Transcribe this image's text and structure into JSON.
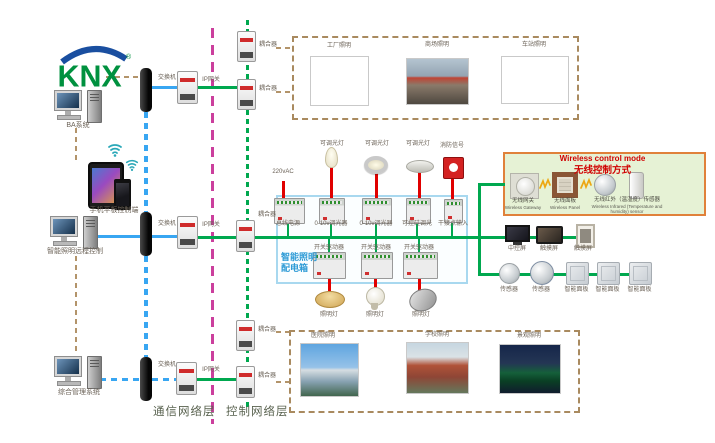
{
  "logo": {
    "text": "KNX",
    "reg": "®"
  },
  "left_column": {
    "computers": [
      {
        "label": "BA系统"
      },
      {
        "label": "智能照明远程控制"
      },
      {
        "label": "综合管理系统"
      }
    ],
    "mobile_label": "手机平板控制端"
  },
  "comm_layer": {
    "switch_labels": [
      "交换机",
      "交换机",
      "交换机"
    ],
    "gateway_labels": [
      "IP网关",
      "IP网关",
      "IP网关"
    ],
    "layer_label": "通信网络层"
  },
  "ctrl_layer": {
    "coupler_labels": [
      "耦合器",
      "耦合器",
      "耦合器",
      "耦合器",
      "耦合器"
    ],
    "layer_label": "控制网络层"
  },
  "top_photos": {
    "labels": [
      "工厂照明",
      "商场照明",
      "车站照明"
    ]
  },
  "bottom_photos": {
    "labels": [
      "医院照明",
      "学校照明",
      "景观照明"
    ]
  },
  "cabinet": {
    "title_line1": "智能照明",
    "title_line2": "配电箱",
    "power_label": "220vAC",
    "top_device_labels": [
      "可调光灯",
      "可调光灯",
      "可调光灯",
      "消防信号"
    ],
    "row1_labels": [
      "总线电源",
      "0-10v调光器",
      "0-10v调光器",
      "可控硅调光",
      "干接点输入"
    ],
    "row2_labels": [
      "开关驱动器",
      "开关驱动器",
      "开关驱动器"
    ],
    "lamp_labels": [
      "照明灯",
      "照明灯",
      "照明灯"
    ]
  },
  "wireless": {
    "title_en": "Wireless control mode",
    "title_zh": "无线控制方式",
    "items": [
      {
        "zh": "无线网关",
        "en": "Wireless Gateway"
      },
      {
        "zh": "无线面板",
        "en": "Wireless Panel"
      },
      {
        "zh": "无线红外（温湿度）传感器",
        "en": "Wireless Infrared (Temperature and humidity) sensor"
      }
    ]
  },
  "right_devices": {
    "screens": [
      "中控屏",
      "触摸屏",
      "触摸屏"
    ],
    "sensors": [
      "传感器",
      "传感器"
    ],
    "panels": [
      "智能面板",
      "智能面板",
      "智能面板"
    ]
  },
  "colors": {
    "bus_green": "#00a84f",
    "lan_blue": "#38a6f2",
    "tan": "#b3946a",
    "magenta": "#cb3f9d",
    "power_red": "#e00000",
    "cabinet_border": "#a8d8ef",
    "cabinet_title": "#2e9bd6",
    "wireless_border": "#e0813a",
    "wireless_bg": "#e6f2d5",
    "wireless_title": "#d00000",
    "knx_green": "#00913f",
    "knx_blue": "#1a4fa0"
  }
}
